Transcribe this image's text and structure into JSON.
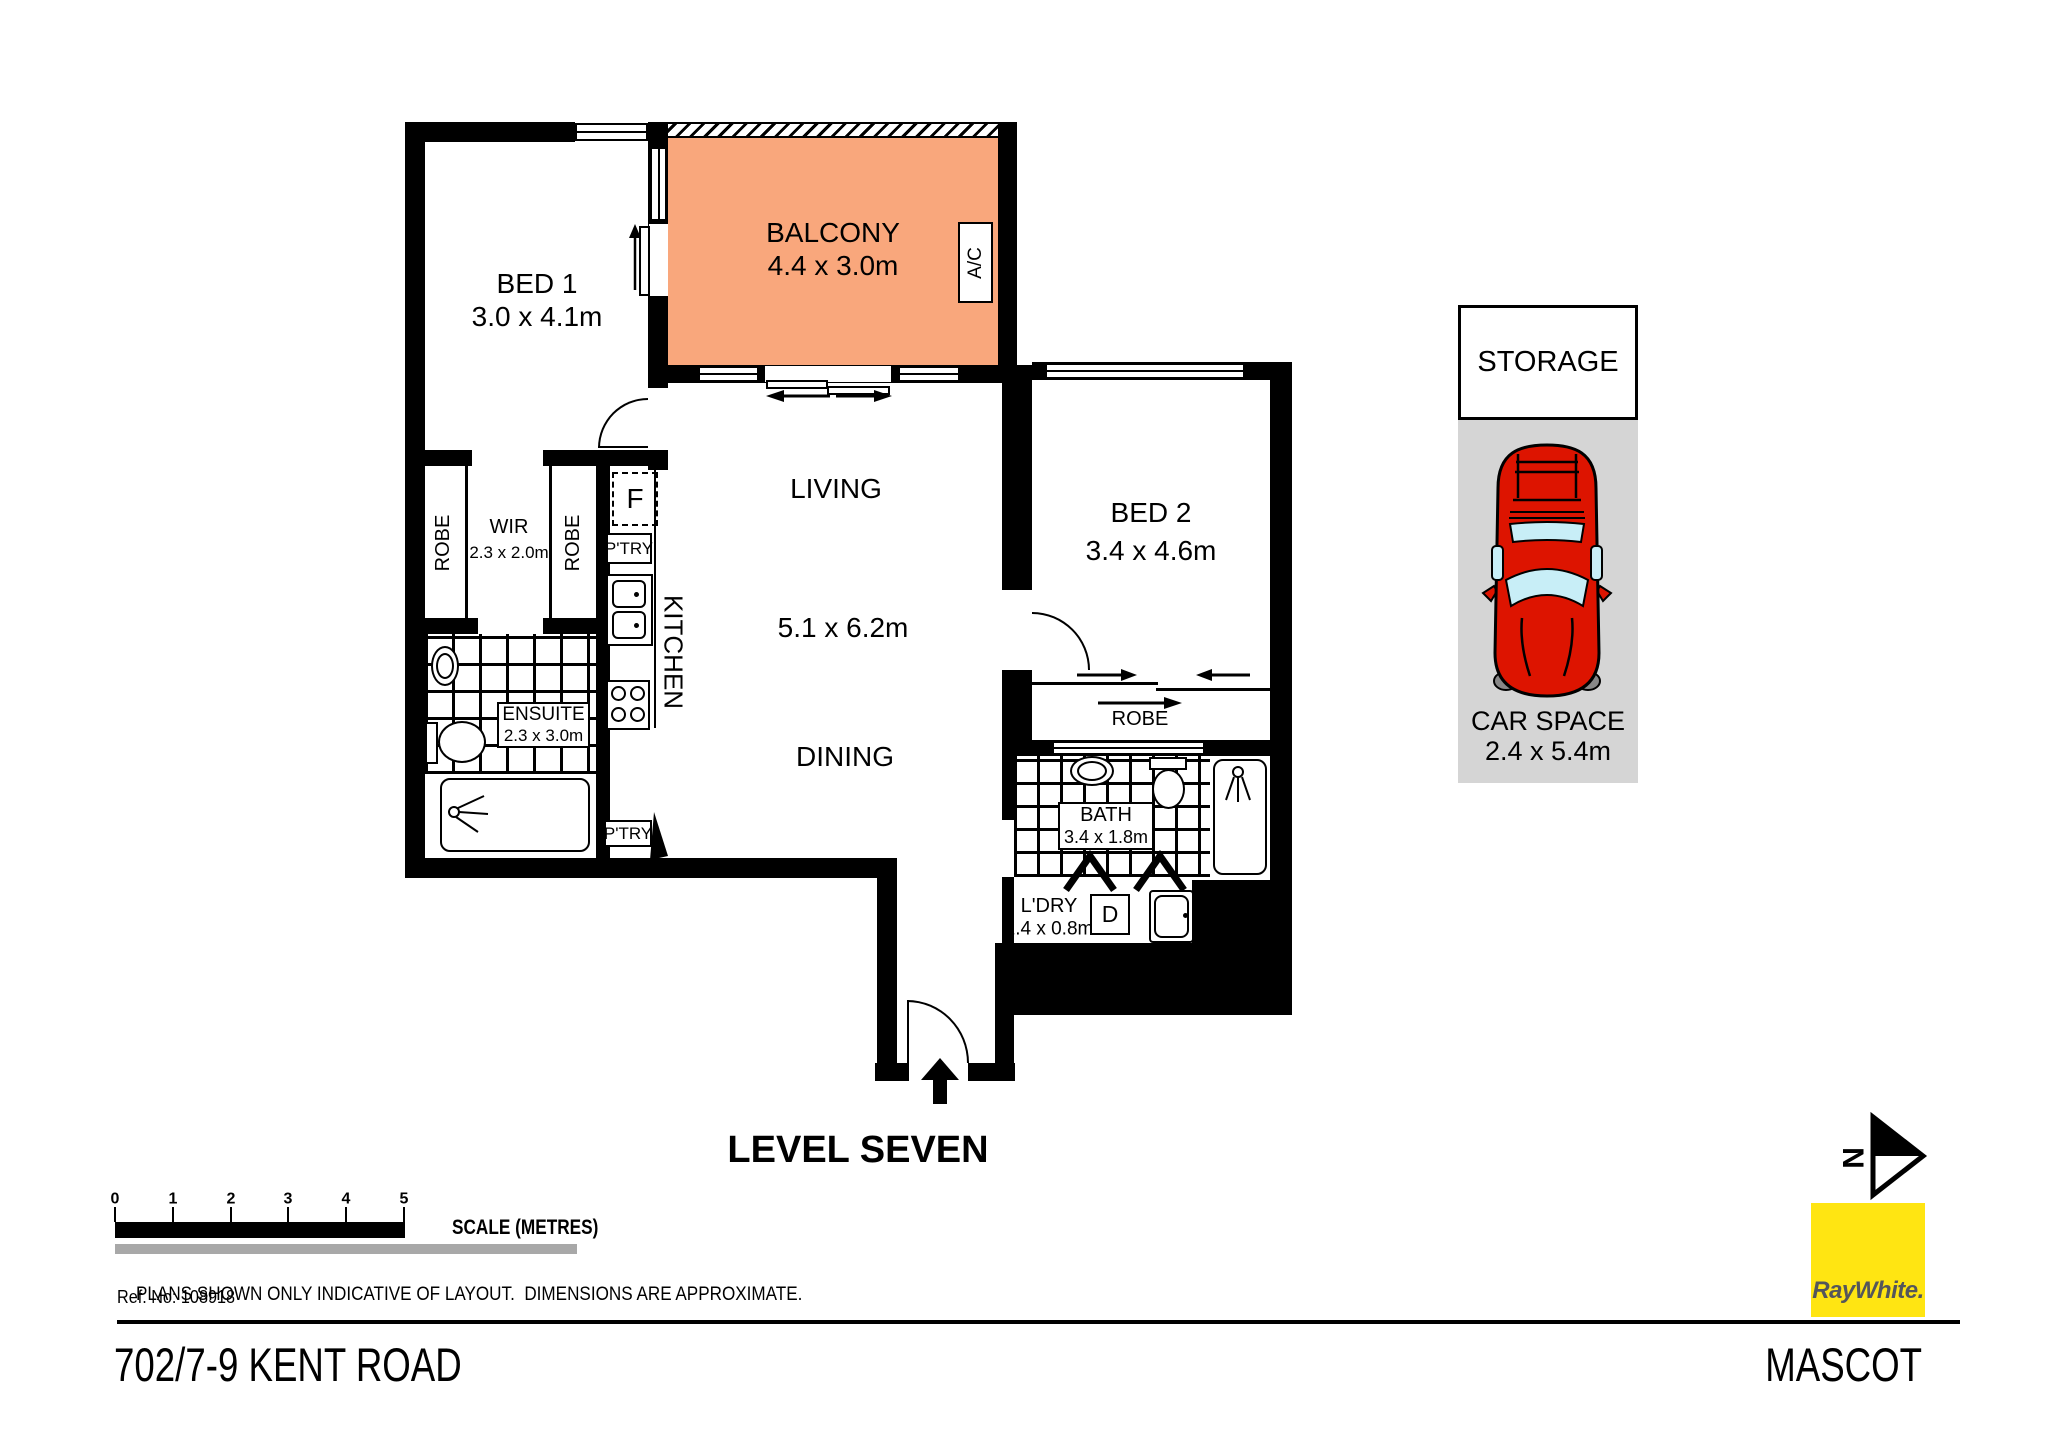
{
  "plan": {
    "level_label": "LEVEL SEVEN",
    "rooms": {
      "bed1": {
        "label": "BED 1",
        "dims": "3.0 x 4.1m"
      },
      "balcony": {
        "label": "BALCONY",
        "dims": "4.4 x 3.0m"
      },
      "living": {
        "label": "LIVING"
      },
      "living_dining_dims": "5.1 x 6.2m",
      "dining": {
        "label": "DINING"
      },
      "kitchen": {
        "label": "KITCHEN"
      },
      "wir": {
        "label": "WIR",
        "dims": "2.3 x 2.0m"
      },
      "ensuite": {
        "label": "ENSUITE",
        "dims": "2.3 x 3.0m"
      },
      "bed2": {
        "label": "BED 2",
        "dims": "3.4 x 4.6m"
      },
      "bath": {
        "label": "BATH",
        "dims": "3.4 x 1.8m"
      },
      "laundry": {
        "label": "L'DRY",
        "dims": "2.4 x 0.8m"
      }
    },
    "fixtures": {
      "robe_left": "ROBE",
      "robe_right": "ROBE",
      "robe_bed2": "ROBE",
      "pantry_upper": "P'TRY",
      "pantry_lower": "P'TRY",
      "fridge": "F",
      "dryer": "D",
      "aircon": "A/C"
    }
  },
  "parking": {
    "storage_label": "STORAGE",
    "carspace_label": "CAR SPACE",
    "carspace_dims": "2.4 x 5.4m"
  },
  "scalebar": {
    "ticks": [
      "0",
      "1",
      "2",
      "3",
      "4",
      "5"
    ],
    "label": "SCALE (METRES)"
  },
  "footer": {
    "disclaimer": "PLANS SHOWN ONLY INDICATIVE OF LAYOUT.  DIMENSIONS ARE APPROXIMATE.",
    "ref": "Ref. No: 108918",
    "address": "702/7-9 KENT ROAD",
    "suburb": "MASCOT"
  },
  "compass": {
    "north": "N"
  },
  "brand": {
    "logo_text": "RayWhite."
  },
  "colors": {
    "balcony_fill": "#F9A77C",
    "carspace_fill": "#D5D5D5",
    "car_body": "#DD1400",
    "car_glass": "#C8EEF7",
    "brand_yellow": "#FFE512",
    "brand_text": "#54565B",
    "scalebar_gray": "#A8A8A8"
  }
}
